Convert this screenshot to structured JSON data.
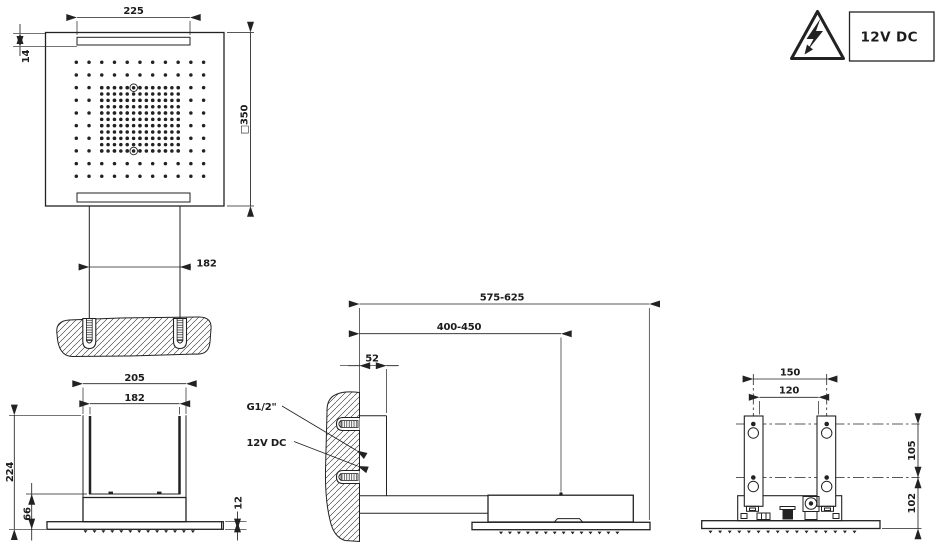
{
  "badge": {
    "label": "12V DC",
    "symbol": "high-voltage-warning"
  },
  "views": {
    "plan": {
      "dim_slot_length": "225",
      "dim_slot_offset": "14",
      "dim_square_size": "□350"
    },
    "ceiling_section": {
      "dim_anchor_spacing": "182"
    },
    "front": {
      "dim_outer_width": "205",
      "dim_inner_width": "182",
      "dim_total_height": "224",
      "dim_body_height": "66",
      "dim_plate_thickness": "12"
    },
    "side": {
      "dim_total_reach": "575-625",
      "dim_head_center_reach": "400-450",
      "dim_wall_offset": "52",
      "label_water_connection": "G1/2\"",
      "label_power_connection": "12V DC"
    },
    "rear": {
      "dim_anchor_spacing_h": "150",
      "dim_inner_width": "120",
      "dim_anchor_spacing_v": "105",
      "dim_anchor_to_bottom": "102"
    }
  },
  "nozzle_layout": {
    "plan_outer_grid": {
      "cols": 11,
      "rows": 10,
      "x0": 76.3,
      "y0": 62.3,
      "dx": 12.73,
      "dy": 12.66,
      "r": 1.75
    },
    "plan_inner_grid": {
      "cols": 13,
      "rows": 11,
      "x0": 101.7,
      "y0": 87.7,
      "dx": 6.38,
      "dy": 6.33,
      "r": 1.75
    },
    "plan_ringed_nozzles": [
      [
        133.7,
        87.7
      ],
      [
        133.7,
        151.0
      ]
    ],
    "ring_radius": 3.8,
    "strips": {
      "front": {
        "count": 13,
        "x0": 85.5,
        "dx": 8.95,
        "y": 530.2
      },
      "side": {
        "count": 14,
        "x0": 501.0,
        "dx": 8.95,
        "y": 531.6
      },
      "rear": {
        "count": 16,
        "x0": 710.5,
        "dx": 9.6,
        "y": 530.6
      }
    }
  },
  "colors": {
    "ink": "#222222",
    "paper": "#ffffff"
  }
}
